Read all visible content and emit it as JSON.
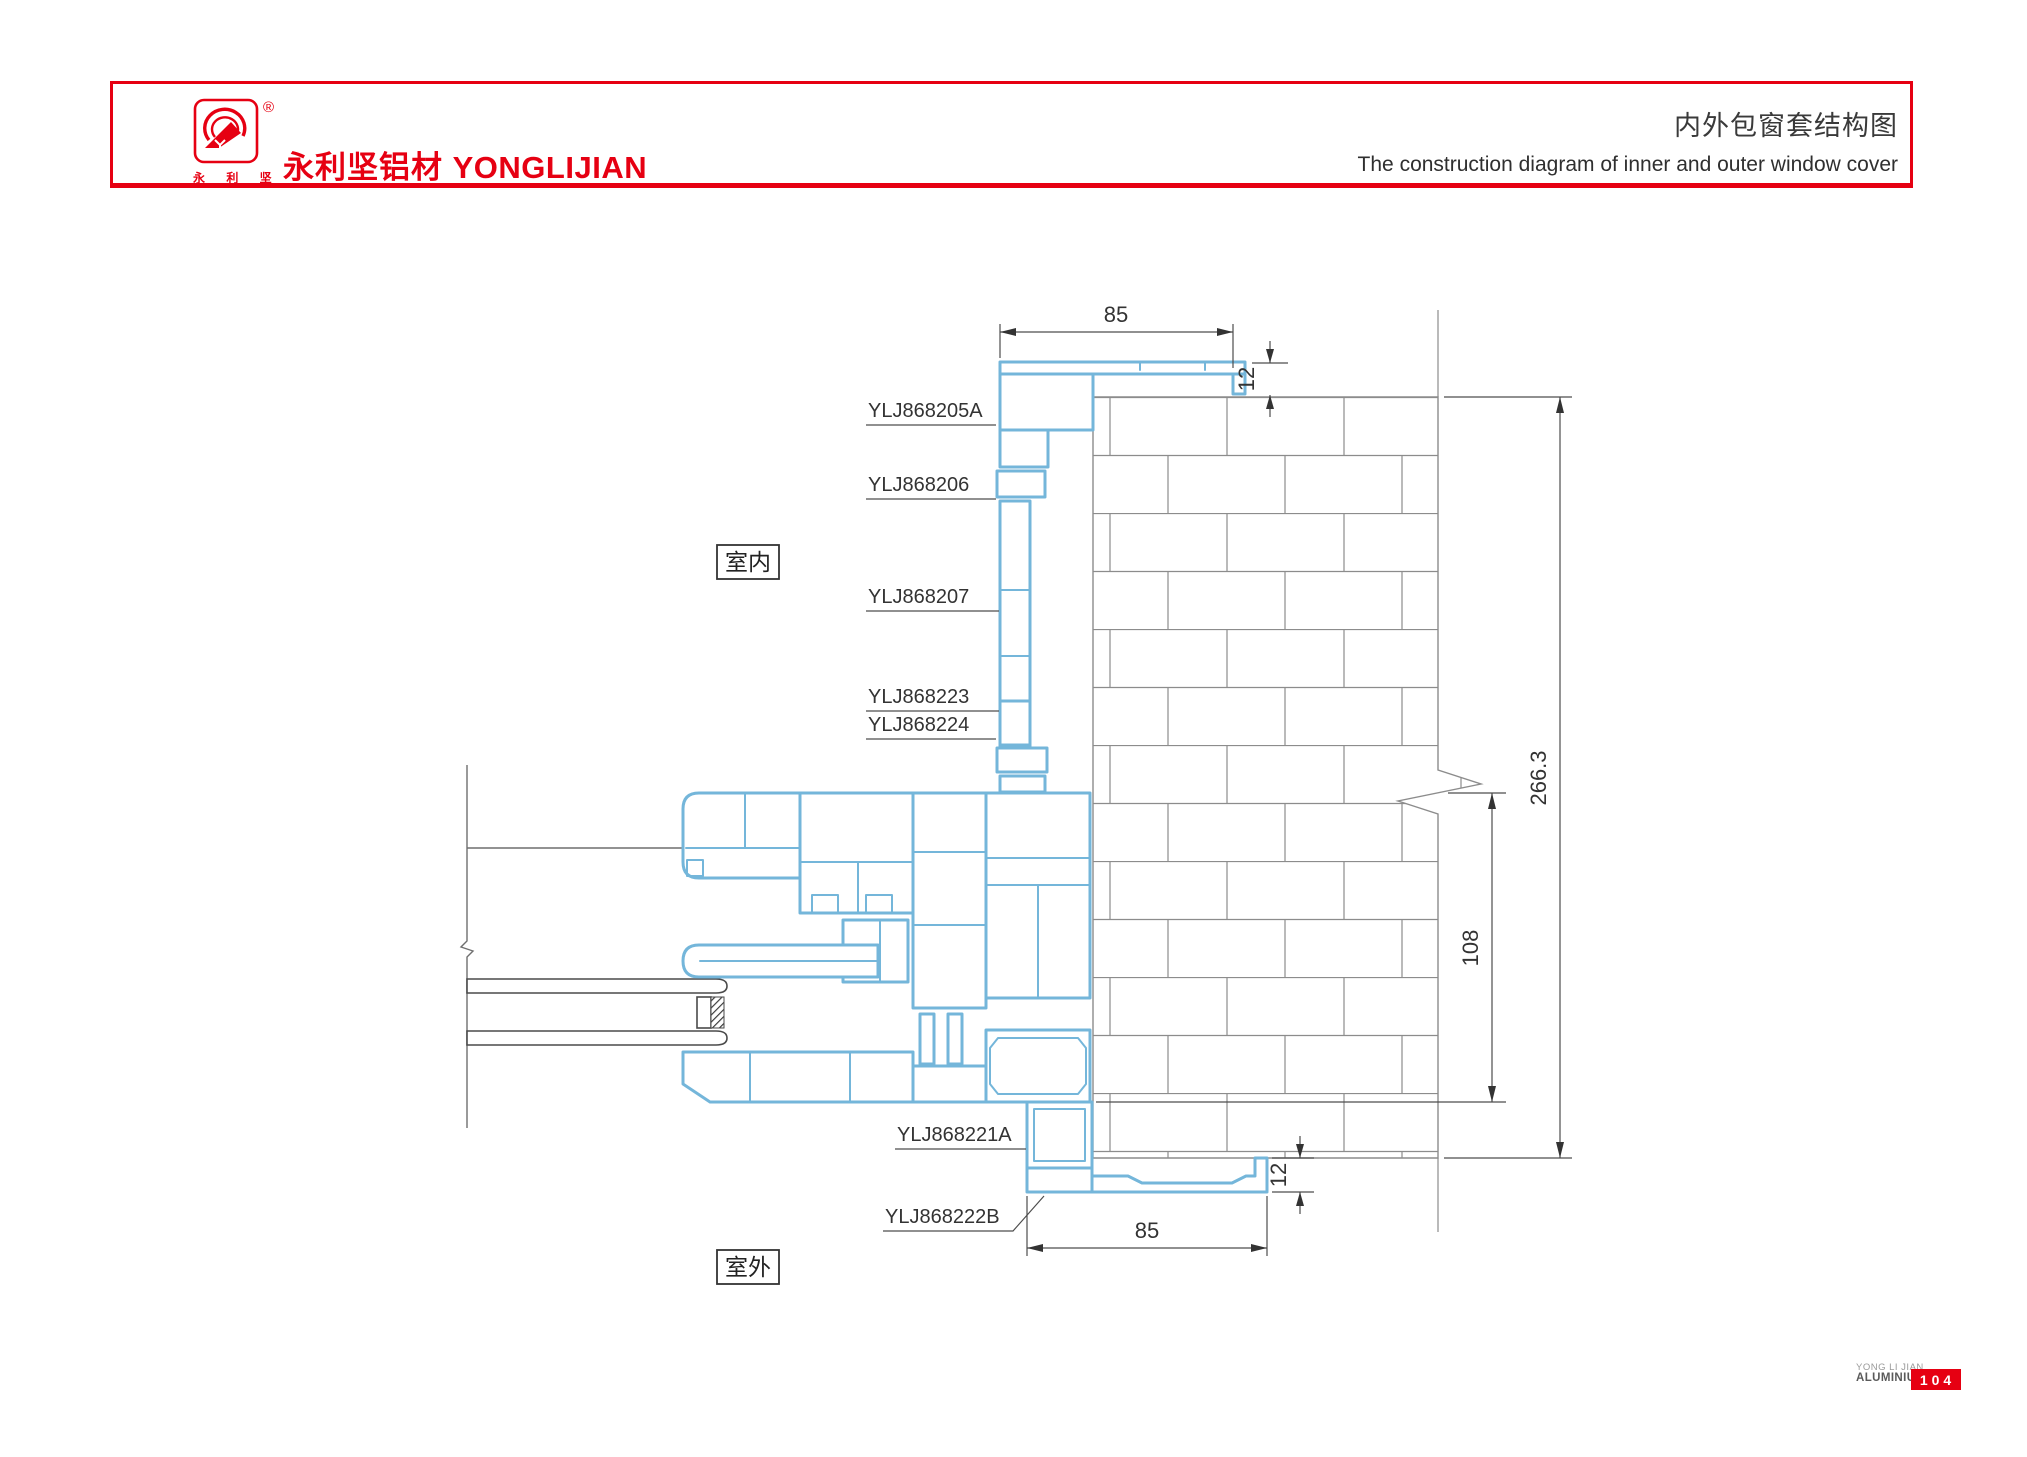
{
  "header": {
    "brand_cn": "永利坚铝材",
    "brand_en": "YONGLIJIAN",
    "logo_chars": "永 利 坚",
    "registered_mark": "®",
    "title_cn": "内外包窗套结构图",
    "title_en": "The construction diagram of inner and outer window cover"
  },
  "diagram": {
    "room_labels": {
      "indoor": "室内",
      "outdoor": "室外"
    },
    "part_labels": [
      {
        "text": "YLJ868205A"
      },
      {
        "text": "YLJ868206"
      },
      {
        "text": "YLJ868207"
      },
      {
        "text": "YLJ868223"
      },
      {
        "text": "YLJ868224"
      },
      {
        "text": "YLJ868221A"
      },
      {
        "text": "YLJ868222B"
      }
    ],
    "dimensions": {
      "top_width": "85",
      "top_offset": "12",
      "overall_height": "266.3",
      "inner_height": "108",
      "bottom_width": "85",
      "bottom_offset": "12"
    }
  },
  "footer": {
    "company_line1": "YONG LI JIAN",
    "company_line2": "ALUMINIUM",
    "page_number": "104"
  },
  "colors": {
    "brand_red": "#e60012",
    "profile_blue": "#74b6da",
    "wall_gray": "#8c8c8c",
    "dim_gray": "#4d4d4d"
  }
}
